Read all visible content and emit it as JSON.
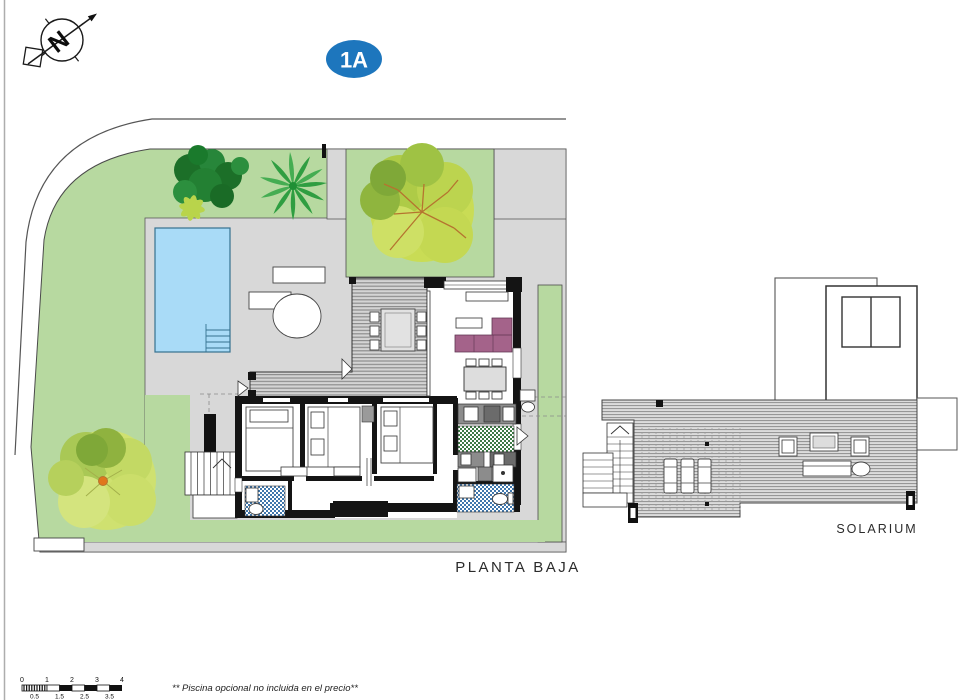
{
  "badge": {
    "label": "1A",
    "color": "#1d76bd"
  },
  "compass": {
    "letter": "N"
  },
  "ground_floor": {
    "caption": "PLANTA BAJA"
  },
  "solarium": {
    "caption": "SOLARIUM"
  },
  "scale_bar": {
    "top_labels": [
      "0",
      "1",
      "2",
      "3",
      "4"
    ],
    "bottom_labels": [
      "0.5",
      "1.5",
      "2.5",
      "3.5"
    ]
  },
  "footnote": {
    "text": "** Piscina opcional no incluida en el precio**"
  },
  "colors": {
    "garden_green": "#b7d9a0",
    "terrace_gray": "#d8d8d8",
    "pool_blue": "#a9dbf7",
    "sofa_mauve": "#a4638a",
    "kitchen_tile_green": "#3e7a46",
    "bath_tile_blue": "#4077ac"
  }
}
